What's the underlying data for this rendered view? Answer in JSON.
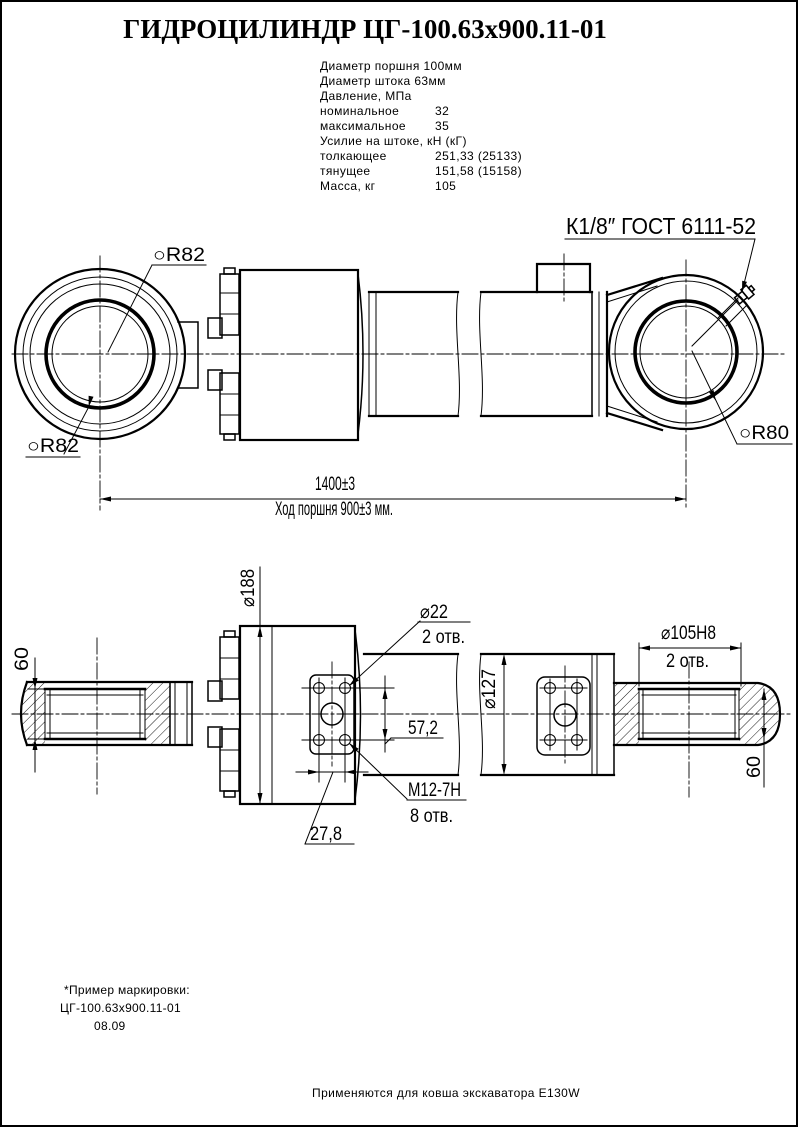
{
  "title": "ГИДРОЦИЛИНДР ЦГ-100.63х900.11-01",
  "specs": {
    "rows": [
      {
        "label": "Диаметр поршня 100мм",
        "value": ""
      },
      {
        "label": "Диаметр штока 63мм",
        "value": ""
      },
      {
        "label": "Давление, МПа",
        "value": ""
      },
      {
        "label": "номинальное",
        "value": "32"
      },
      {
        "label": "максимальное",
        "value": "35"
      },
      {
        "label": "Усилие на штоке, кН (кГ)",
        "value": ""
      },
      {
        "label": "толкающее",
        "value": "251,33 (25133)"
      },
      {
        "label": "тянущее",
        "value": "151,58 (15158)"
      },
      {
        "label": "Масса, кг",
        "value": "105"
      }
    ]
  },
  "side_view": {
    "port_label": "К1/8″ ГОСТ 6111-52",
    "r82_top": "○R82",
    "r82_bottom": "○R82",
    "r80": "○R80",
    "overall_length": "1400±3",
    "stroke_note": "Ход поршня 900±3 мм."
  },
  "bottom_view": {
    "body_dia": "⌀188",
    "hole_dia": "⌀22",
    "hole_qty": "2 отв.",
    "hole_spacing_v": "57,2",
    "thread": "М12-7Н",
    "thread_qty": "8 отв.",
    "hole_spacing_h": "27,8",
    "barrel_dia": "⌀127",
    "eye_bore": "⌀105Н8",
    "eye_bore_qty": "2 отв.",
    "eye_width_left": "60",
    "eye_width_right": "60"
  },
  "marking": {
    "line1": "*Пример маркировки:",
    "line2": "ЦГ-100.63х900.11-01",
    "line3": "08.09"
  },
  "footer": {
    "note": "Применяются для ковша экскаватора Е130W"
  }
}
